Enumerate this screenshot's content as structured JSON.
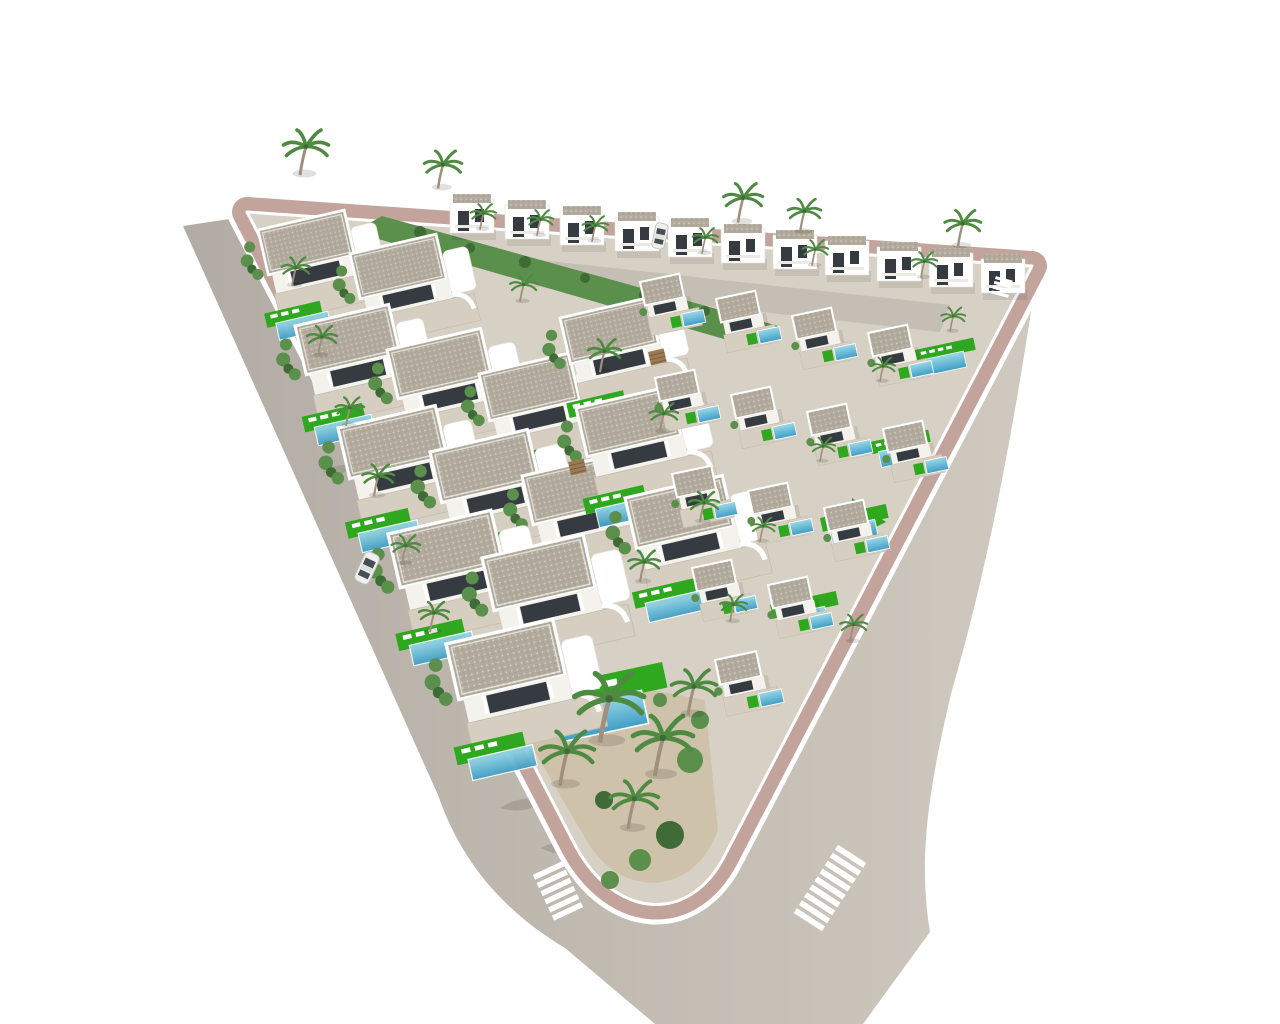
{
  "scene": {
    "type": "3d-aerial-architectural-render",
    "description": "Aerial 3D render of a triangular residential development with white Mediterranean villas, private pools with green turf decks, palm trees, a perimeter road with zebra crossings and a white car"
  },
  "colors": {
    "background": "#ffffff",
    "road_dark": "#b2aca4",
    "road_mid": "#c2bcb3",
    "road_light": "#cfc9c0",
    "curb": "#ffffff",
    "sidewalk": "#bc9a92",
    "ground": "#d7d0c4",
    "inner_street": "#c4beb4",
    "gravel": "#b2ab9d",
    "villa_white": "#ffffff",
    "terrace": "#d6cfc1",
    "glass": "#363b41",
    "pool_deep": "#3f9ec5",
    "pool_light": "#9ad8e8",
    "turf": "#2fa81f",
    "hedge": "#5a8f4c",
    "hedge_dark": "#3e6b36",
    "palm_frond": "#4e8a41",
    "palm_trunk": "#a08f7a",
    "sand": "#cfc2ab",
    "car_body": "#eff0ee",
    "crosswalk": "#ffffff",
    "pergola_wood": "#9b7b54"
  },
  "counts": {
    "two_story_villas_back_row": 11,
    "single_story_villas": 14,
    "small_villas": 14,
    "standalone_pools": 5,
    "palm_trees": 33,
    "vehicles": 2,
    "zebra_crossings": 3,
    "pergolas": 2
  },
  "objects": {
    "rotations": {
      "large_villa": -13,
      "small_villa": -12,
      "edge_pool": -12,
      "back_villa": 0
    },
    "back_row_villas": [
      [
        450,
        193
      ],
      [
        505,
        199
      ],
      [
        560,
        205
      ],
      [
        615,
        211
      ],
      [
        668,
        217
      ],
      [
        721,
        223
      ],
      [
        773,
        229
      ],
      [
        825,
        235
      ],
      [
        877,
        241
      ],
      [
        929,
        247
      ],
      [
        981,
        253
      ]
    ],
    "large_villas": [
      [
        258,
        230,
        0.92
      ],
      [
        350,
        254,
        0.92
      ],
      [
        295,
        326,
        1.0
      ],
      [
        387,
        350,
        1.0
      ],
      [
        479,
        374,
        0.96
      ],
      [
        560,
        318,
        0.94
      ],
      [
        338,
        428,
        1.04
      ],
      [
        430,
        452,
        1.04
      ],
      [
        522,
        476,
        1.0
      ],
      [
        576,
        408,
        1.0
      ],
      [
        388,
        534,
        1.1
      ],
      [
        482,
        558,
        1.08
      ],
      [
        625,
        498,
        1.04
      ],
      [
        446,
        644,
        1.14
      ]
    ],
    "small_villas": [
      [
        640,
        282,
        1
      ],
      [
        716,
        299,
        1
      ],
      [
        792,
        316,
        1
      ],
      [
        868,
        333,
        1
      ],
      [
        655,
        378,
        1
      ],
      [
        731,
        395,
        1
      ],
      [
        807,
        412,
        1
      ],
      [
        883,
        429,
        1
      ],
      [
        672,
        474,
        1
      ],
      [
        748,
        491,
        1
      ],
      [
        824,
        508,
        1
      ],
      [
        692,
        568,
        1
      ],
      [
        768,
        585,
        1
      ],
      [
        715,
        660,
        1.05
      ]
    ],
    "edge_pools": [
      [
        915,
        350,
        0.62
      ],
      [
        870,
        442,
        0.62
      ],
      [
        820,
        518,
        0.7
      ],
      [
        770,
        605,
        0.7
      ],
      [
        540,
        688,
        1.3
      ]
    ],
    "palms": [
      [
        300,
        172,
        1.5
      ],
      [
        438,
        186,
        1.25
      ],
      [
        738,
        220,
        1.3
      ],
      [
        800,
        230,
        1.1
      ],
      [
        958,
        244,
        1.2
      ],
      [
        480,
        228,
        0.85
      ],
      [
        537,
        234,
        0.85
      ],
      [
        592,
        240,
        0.85
      ],
      [
        702,
        252,
        0.85
      ],
      [
        812,
        264,
        0.85
      ],
      [
        921,
        276,
        0.85
      ],
      [
        292,
        284,
        0.95
      ],
      [
        318,
        354,
        1.0
      ],
      [
        346,
        424,
        0.95
      ],
      [
        374,
        494,
        1.05
      ],
      [
        402,
        562,
        0.95
      ],
      [
        430,
        630,
        1.0
      ],
      [
        520,
        300,
        0.9
      ],
      [
        600,
        370,
        1.1
      ],
      [
        660,
        430,
        0.95
      ],
      [
        700,
        520,
        1.0
      ],
      [
        640,
        580,
        1.05
      ],
      [
        730,
        620,
        0.9
      ],
      [
        880,
        380,
        0.8
      ],
      [
        950,
        330,
        0.8
      ],
      [
        820,
        460,
        0.8
      ],
      [
        760,
        540,
        0.8
      ],
      [
        850,
        640,
        0.9
      ],
      [
        600,
        738,
        2.3
      ],
      [
        655,
        772,
        2.0
      ],
      [
        560,
        782,
        1.8
      ],
      [
        688,
        712,
        1.5
      ],
      [
        628,
        826,
        1.6
      ]
    ],
    "pergolas": [
      [
        568,
        462
      ],
      [
        648,
        352
      ]
    ],
    "vehicles": [
      {
        "x": 367,
        "y": 568,
        "r": 25,
        "s": 1.0,
        "kind": "car"
      },
      {
        "x": 660,
        "y": 236,
        "r": 12,
        "s": 0.8,
        "kind": "van"
      }
    ],
    "crosswalks": [
      {
        "x": 558,
        "y": 891,
        "r": -25,
        "stripes": 6,
        "s": 1.0
      },
      {
        "x": 830,
        "y": 888,
        "r": 33,
        "stripes": 9,
        "s": 1.05
      },
      {
        "x": 1002,
        "y": 287,
        "r": 15,
        "stripes": 4,
        "s": 0.55
      }
    ]
  }
}
